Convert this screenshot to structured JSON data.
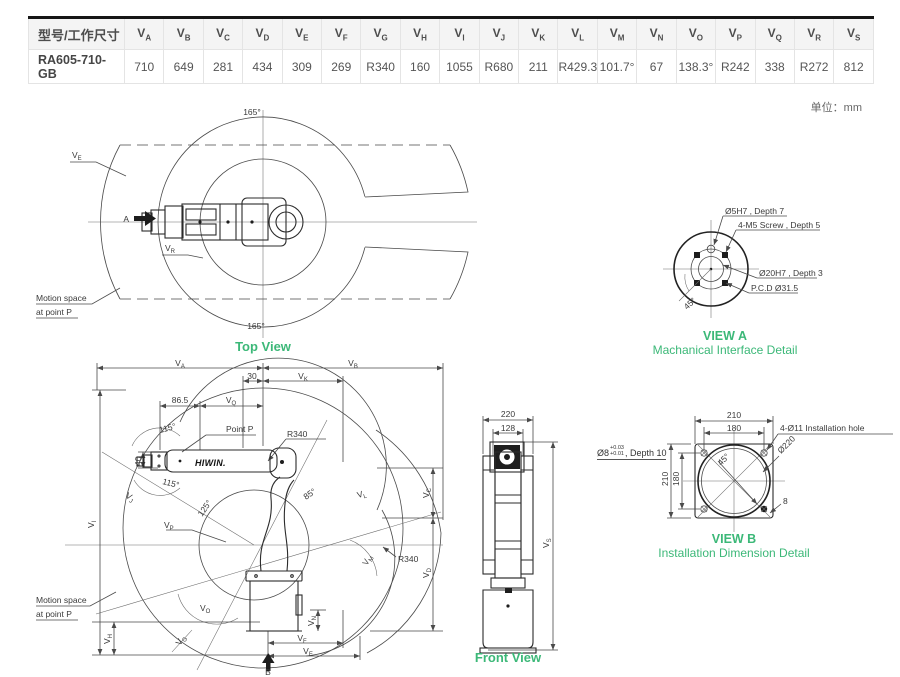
{
  "unit_note": "单位：mm",
  "colors": {
    "accent_green": "#3cb878",
    "line": "#4a4a4a",
    "table_top_border": "#161616",
    "header_bg": "#f4f4f4"
  },
  "table": {
    "model_header": "型号/工作尺寸",
    "model": "RA605-710-GB",
    "columns": [
      {
        "b": "V",
        "s": "A",
        "v": "710"
      },
      {
        "b": "V",
        "s": "B",
        "v": "649"
      },
      {
        "b": "V",
        "s": "C",
        "v": "281"
      },
      {
        "b": "V",
        "s": "D",
        "v": "434"
      },
      {
        "b": "V",
        "s": "E",
        "v": "309"
      },
      {
        "b": "V",
        "s": "F",
        "v": "269"
      },
      {
        "b": "V",
        "s": "G",
        "v": "R340"
      },
      {
        "b": "V",
        "s": "H",
        "v": "160"
      },
      {
        "b": "V",
        "s": "I",
        "v": "1055"
      },
      {
        "b": "V",
        "s": "J",
        "v": "R680"
      },
      {
        "b": "V",
        "s": "K",
        "v": "211"
      },
      {
        "b": "V",
        "s": "L",
        "v": "R429.3"
      },
      {
        "b": "V",
        "s": "M",
        "v": "101.7°"
      },
      {
        "b": "V",
        "s": "N",
        "v": "67"
      },
      {
        "b": "V",
        "s": "O",
        "v": "138.3°"
      },
      {
        "b": "V",
        "s": "P",
        "v": "R242"
      },
      {
        "b": "V",
        "s": "Q",
        "v": "338"
      },
      {
        "b": "V",
        "s": "R",
        "v": "R272"
      },
      {
        "b": "V",
        "s": "S",
        "v": "812"
      }
    ]
  },
  "top_view": {
    "title": "Top View",
    "angle_top": "165°",
    "angle_bottom": "165°",
    "ve": {
      "b": "V",
      "s": "E"
    },
    "vr": {
      "b": "V",
      "s": "R"
    },
    "marker_a": "A",
    "motion_space_1": "Motion space",
    "motion_space_2": "at point P"
  },
  "side_view": {
    "va": {
      "b": "V",
      "s": "A"
    },
    "vb": {
      "b": "V",
      "s": "B"
    },
    "vk": {
      "b": "V",
      "s": "K"
    },
    "vq": {
      "b": "V",
      "s": "Q"
    },
    "vi": {
      "b": "V",
      "s": "I"
    },
    "vj": {
      "b": "V",
      "s": "J"
    },
    "vl": {
      "b": "V",
      "s": "L"
    },
    "vc": {
      "b": "V",
      "s": "C"
    },
    "vd": {
      "b": "V",
      "s": "D"
    },
    "vm": {
      "b": "V",
      "s": "M"
    },
    "vp": {
      "b": "V",
      "s": "P"
    },
    "vo": {
      "b": "V",
      "s": "O"
    },
    "vg": {
      "b": "V",
      "s": "G"
    },
    "vh": {
      "b": "V",
      "s": "H"
    },
    "vn": {
      "b": "V",
      "s": "N"
    },
    "vf": {
      "b": "V",
      "s": "F"
    },
    "ve": {
      "b": "V",
      "s": "E"
    },
    "dim_30": "30",
    "dim_865": "86.5",
    "dim_40": "40",
    "angle_115a": "115°",
    "angle_115b": "115°",
    "angle_125": "125°",
    "angle_85": "85°",
    "r340_a": "R340",
    "r340_b": "R340",
    "point_p": "Point P",
    "marker_b": "B",
    "motion_space_1": "Motion space",
    "motion_space_2": "at point P",
    "logo": "HIWIN."
  },
  "front_view": {
    "title": "Front View",
    "dim_220": "220",
    "dim_128": "128",
    "vs": {
      "b": "V",
      "s": "S"
    }
  },
  "view_a": {
    "title": "VIEW A",
    "subtitle": "Machanical Interface Detail",
    "label_pin": "Ø5H7 , Depth 7",
    "label_screw": "4-M5 Screw , Depth 5",
    "label_bore": "Ø20H7 , Depth 3",
    "label_pcd": "P.C.D Ø31.5",
    "angle_45": "45°"
  },
  "view_b": {
    "title": "VIEW B",
    "subtitle": "Installation Dimension Detail",
    "dim_210_top": "210",
    "dim_180_top": "180",
    "dim_210_left": "210",
    "dim_180_left": "180",
    "label_hole": "4-Ø11 Installation hole",
    "label_boss": "Ø220",
    "angle_45": "45°",
    "dim_8": "8",
    "pin_label": {
      "base": "Ø8",
      "tol_top": "+0.03",
      "tol_bot": "+0.01",
      "rest": ", Depth 10"
    }
  }
}
